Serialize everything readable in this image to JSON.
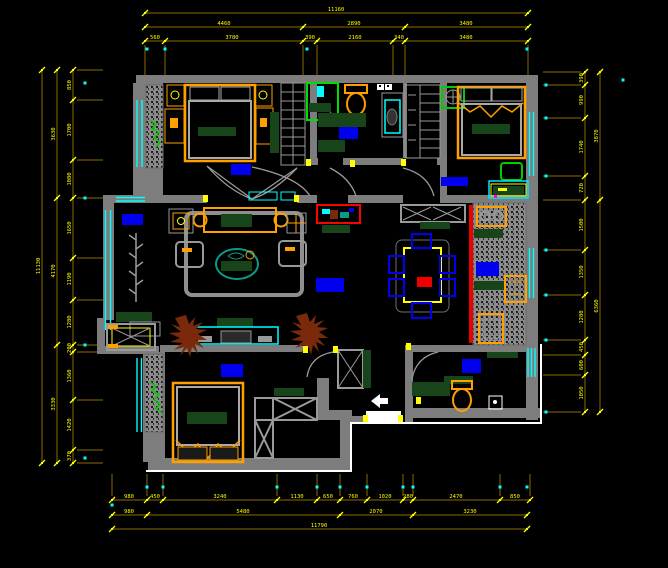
{
  "colors": {
    "bg": "#000000",
    "wall": "#7d7d7d",
    "furn_gray": "#9a9a9a",
    "dim_line": "#8a6d00",
    "dim_tick": "#ffff00",
    "dim_text": "#ffff00",
    "window_cyan": "#00ffff",
    "accent_orange": "#ffa000",
    "accent_yellow": "#ffff00",
    "dark_green": "#174419",
    "bright_green": "#00cc00",
    "shower_green": "#00dd00",
    "rug_blue": "#0000ee",
    "red": "#ee0000",
    "plant_brown": "#7a2a0a",
    "plant_teal": "#0b9b85",
    "magenta": "#ff00ff",
    "white": "#ffffff"
  },
  "entry": {
    "arrow_icon": "left-arrow",
    "door_mat": "entry-threshold"
  },
  "dimensions": {
    "chains": [
      {
        "o": "h",
        "y": 13,
        "x1": 145,
        "x2": 528,
        "ticks": [
          145,
          528
        ],
        "labels": [
          {
            "p": 336,
            "t": "11160"
          }
        ]
      },
      {
        "o": "h",
        "y": 27,
        "x1": 145,
        "x2": 528,
        "ticks": [
          145,
          303,
          405,
          528
        ],
        "labels": [
          {
            "p": 224,
            "t": "4460"
          },
          {
            "p": 354,
            "t": "2890"
          },
          {
            "p": 466,
            "t": "3480"
          }
        ]
      },
      {
        "o": "h",
        "y": 41,
        "x1": 145,
        "x2": 528,
        "ext": 34,
        "ticks": [
          145,
          165,
          303,
          317,
          393,
          405,
          528
        ],
        "labels": [
          {
            "p": 155,
            "t": "560"
          },
          {
            "p": 232,
            "t": "3780"
          },
          {
            "p": 310,
            "t": "390"
          },
          {
            "p": 355,
            "t": "2160"
          },
          {
            "p": 399,
            "t": "340"
          },
          {
            "p": 466,
            "t": "3480"
          }
        ]
      },
      {
        "o": "h",
        "y": 500,
        "x1": 112,
        "x2": 530,
        "ext": -26,
        "ticks": [
          112,
          147,
          163,
          277,
          317,
          340,
          367,
          403,
          413,
          500,
          530
        ],
        "labels": [
          {
            "p": 129,
            "t": "980"
          },
          {
            "p": 155,
            "t": "450"
          },
          {
            "p": 220,
            "t": "3240"
          },
          {
            "p": 297,
            "t": "1130"
          },
          {
            "p": 328,
            "t": "650"
          },
          {
            "p": 353,
            "t": "760"
          },
          {
            "p": 385,
            "t": "1020"
          },
          {
            "p": 408,
            "t": "280"
          },
          {
            "p": 456,
            "t": "2470"
          },
          {
            "p": 515,
            "t": "850"
          }
        ]
      },
      {
        "o": "h",
        "y": 515,
        "x1": 112,
        "x2": 527,
        "ticks": [
          112,
          147,
          340,
          413,
          527
        ],
        "labels": [
          {
            "p": 129,
            "t": "980"
          },
          {
            "p": 243,
            "t": "5480"
          },
          {
            "p": 376,
            "t": "2070"
          },
          {
            "p": 470,
            "t": "3230"
          }
        ]
      },
      {
        "o": "h",
        "y": 529,
        "x1": 112,
        "x2": 527,
        "ticks": [
          112,
          527
        ],
        "labels": [
          {
            "p": 319,
            "t": "11790"
          }
        ]
      },
      {
        "o": "v",
        "x": 42,
        "y1": 70,
        "y2": 463,
        "ticks": [
          70,
          463
        ],
        "labels": [
          {
            "p": 266,
            "t": "11130"
          }
        ]
      },
      {
        "o": "v",
        "x": 57,
        "y1": 70,
        "y2": 463,
        "ticks": [
          70,
          198,
          345,
          463
        ],
        "labels": [
          {
            "p": 134,
            "t": "3630"
          },
          {
            "p": 271,
            "t": "4170"
          },
          {
            "p": 404,
            "t": "3330"
          }
        ]
      },
      {
        "o": "v",
        "x": 73,
        "y1": 70,
        "y2": 463,
        "ext": 30,
        "ticks": [
          70,
          100,
          160,
          198,
          258,
          300,
          345,
          352,
          400,
          450,
          463
        ],
        "labels": [
          {
            "p": 85,
            "t": "850"
          },
          {
            "p": 130,
            "t": "1700"
          },
          {
            "p": 179,
            "t": "1080"
          },
          {
            "p": 228,
            "t": "1650"
          },
          {
            "p": 279,
            "t": "1190"
          },
          {
            "p": 322,
            "t": "1280"
          },
          {
            "p": 348,
            "t": "200"
          },
          {
            "p": 376,
            "t": "1360"
          },
          {
            "p": 425,
            "t": "1420"
          },
          {
            "p": 456,
            "t": "370"
          }
        ]
      },
      {
        "o": "v",
        "x": 600,
        "y1": 72,
        "y2": 412,
        "ticks": [
          72,
          200,
          412
        ],
        "labels": [
          {
            "p": 136,
            "t": "3870"
          },
          {
            "p": 306,
            "t": "6360"
          }
        ]
      },
      {
        "o": "v",
        "x": 585,
        "y1": 72,
        "y2": 412,
        "ext": -42,
        "ticks": [
          72,
          85,
          118,
          176,
          200,
          250,
          295,
          340,
          355,
          375,
          412
        ],
        "labels": [
          {
            "p": 78,
            "t": "390"
          },
          {
            "p": 100,
            "t": "990"
          },
          {
            "p": 147,
            "t": "1740"
          },
          {
            "p": 188,
            "t": "720"
          },
          {
            "p": 225,
            "t": "1500"
          },
          {
            "p": 272,
            "t": "1350"
          },
          {
            "p": 317,
            "t": "1280"
          },
          {
            "p": 347,
            "t": "450"
          },
          {
            "p": 365,
            "t": "600"
          },
          {
            "p": 393,
            "t": "1050"
          }
        ]
      }
    ],
    "cyan_dots": [
      [
        147,
        49
      ],
      [
        165,
        49
      ],
      [
        307,
        49
      ],
      [
        527,
        49
      ],
      [
        85,
        83
      ],
      [
        85,
        198
      ],
      [
        85,
        345
      ],
      [
        85,
        458
      ],
      [
        546,
        85
      ],
      [
        546,
        118
      ],
      [
        546,
        176
      ],
      [
        546,
        250
      ],
      [
        546,
        295
      ],
      [
        546,
        340
      ],
      [
        546,
        412
      ],
      [
        623,
        80
      ],
      [
        147,
        487
      ],
      [
        163,
        487
      ],
      [
        277,
        487
      ],
      [
        317,
        487
      ],
      [
        340,
        487
      ],
      [
        367,
        487
      ],
      [
        403,
        487
      ],
      [
        413,
        487
      ],
      [
        500,
        487
      ],
      [
        527,
        487
      ],
      [
        112,
        505
      ]
    ],
    "hinges": [
      [
        306,
        159
      ],
      [
        350,
        160
      ],
      [
        401,
        159
      ],
      [
        203,
        195
      ],
      [
        294,
        195
      ],
      [
        303,
        346
      ],
      [
        333,
        346
      ],
      [
        406,
        343
      ],
      [
        363,
        415
      ],
      [
        398,
        415
      ],
      [
        416,
        397
      ]
    ]
  }
}
